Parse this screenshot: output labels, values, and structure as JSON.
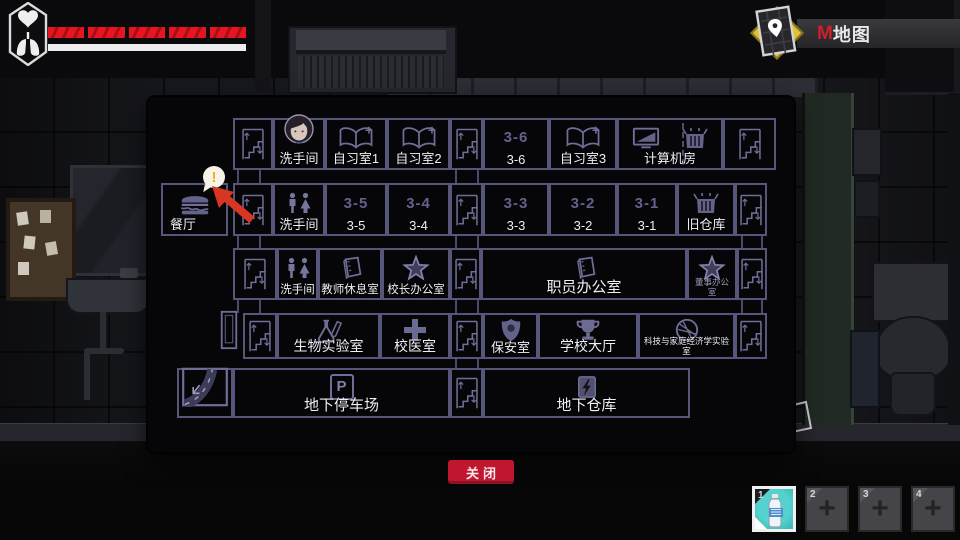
{
  "hud": {
    "health": {
      "segments": 5
    },
    "map_toggle": {
      "hotkey": "M",
      "label": "地图"
    },
    "inventory": {
      "slots": [
        {
          "number": "1",
          "item": "water-bottle",
          "selected": true
        },
        {
          "number": "2",
          "item": null,
          "selected": false
        },
        {
          "number": "3",
          "item": null,
          "selected": false
        },
        {
          "number": "4",
          "item": null,
          "selected": false
        }
      ]
    }
  },
  "panel": {
    "close_label": "关闭",
    "alert": {
      "exclamation": "!"
    },
    "colors": {
      "room_outline": "#56567a",
      "label": "#eef0f5",
      "dim_number": "#62628c",
      "close_button": "#c0172f",
      "alert_yellow": "#e8b41c",
      "arrow_red": "#d93622"
    },
    "rows": [
      {
        "y": 21,
        "h": 52,
        "cells": [
          {
            "type": "stairs",
            "icon": "stairs",
            "x": 85,
            "w": 40
          },
          {
            "type": "room",
            "label": "洗手间",
            "icon": "avatar",
            "x": 125,
            "w": 52
          },
          {
            "type": "room",
            "label": "自习室1",
            "icon": "book",
            "x": 177,
            "w": 62
          },
          {
            "type": "room",
            "label": "自习室2",
            "icon": "book",
            "x": 239,
            "w": 63
          },
          {
            "type": "stairs",
            "icon": "stairs",
            "x": 302,
            "w": 33
          },
          {
            "type": "room",
            "label": "3-6",
            "icon_text": "3-6",
            "x": 335,
            "w": 66
          },
          {
            "type": "room",
            "label": "自习室3",
            "icon": "book",
            "x": 401,
            "w": 68
          },
          {
            "type": "room",
            "label": "计算机房",
            "icon": "computerbox",
            "x": 469,
            "w": 106,
            "dashed": true
          },
          {
            "type": "stairs",
            "icon": "stairs",
            "x": 575,
            "w": 53
          }
        ]
      },
      {
        "y": 86,
        "h": 53,
        "cells": [
          {
            "type": "room",
            "label": "餐厅",
            "icon": "burger",
            "x": 13,
            "w": 67,
            "align": "left"
          },
          {
            "type": "stairs",
            "icon": "stairs",
            "x": 85,
            "w": 40
          },
          {
            "type": "room",
            "label": "洗手间",
            "icon": "wc",
            "x": 125,
            "w": 52
          },
          {
            "type": "room",
            "label": "3-5",
            "icon_text": "3-5",
            "x": 177,
            "w": 62
          },
          {
            "type": "room",
            "label": "3-4",
            "icon_text": "3-4",
            "x": 239,
            "w": 63
          },
          {
            "type": "stairs",
            "icon": "stairs",
            "x": 302,
            "w": 33
          },
          {
            "type": "room",
            "label": "3-3",
            "icon_text": "3-3",
            "x": 335,
            "w": 66
          },
          {
            "type": "room",
            "label": "3-2",
            "icon_text": "3-2",
            "x": 401,
            "w": 68
          },
          {
            "type": "room",
            "label": "3-1",
            "icon_text": "3-1",
            "x": 469,
            "w": 60
          },
          {
            "type": "room",
            "label": "旧仓库",
            "icon": "box",
            "x": 529,
            "w": 58
          },
          {
            "type": "stairs",
            "icon": "stairs",
            "x": 587,
            "w": 32
          }
        ]
      },
      {
        "y": 151,
        "h": 52,
        "cells": [
          {
            "type": "stairs",
            "icon": "stairs",
            "x": 85,
            "w": 44
          },
          {
            "type": "room",
            "label": "洗手间",
            "icon": "wc",
            "x": 129,
            "w": 41,
            "label_size": 11.5
          },
          {
            "type": "room",
            "label": "教师休息室",
            "icon": "notebook",
            "x": 170,
            "w": 64,
            "label_size": 11.5
          },
          {
            "type": "room",
            "label": "校长办公室",
            "icon": "star",
            "x": 234,
            "w": 68,
            "label_size": 11.5
          },
          {
            "type": "stairs",
            "icon": "stairs",
            "x": 302,
            "w": 31
          },
          {
            "type": "room",
            "label": "职员办公室",
            "icon": "notebook",
            "x": 333,
            "w": 206,
            "label_size": 15
          },
          {
            "type": "room",
            "label": "董事办公室",
            "icon": "star",
            "x": 539,
            "w": 50,
            "small": true,
            "dim": true
          },
          {
            "type": "stairs",
            "icon": "stairs",
            "x": 589,
            "w": 30
          }
        ]
      },
      {
        "y": 216,
        "h": 46,
        "cells": [
          {
            "type": "door",
            "icon": "door",
            "x": 68,
            "w": 25
          },
          {
            "type": "stairs",
            "icon": "stairs",
            "x": 95,
            "w": 34
          },
          {
            "type": "room",
            "label": "生物实验室",
            "icon": "flask",
            "x": 129,
            "w": 103,
            "label_size": 14
          },
          {
            "type": "room",
            "label": "校医室",
            "icon": "cross",
            "x": 232,
            "w": 70,
            "label_size": 14
          },
          {
            "type": "stairs",
            "icon": "stairs",
            "x": 302,
            "w": 33
          },
          {
            "type": "room",
            "label": "保安室",
            "icon": "badge",
            "x": 335,
            "w": 55
          },
          {
            "type": "room",
            "label": "学校大厅",
            "icon": "trophy",
            "x": 390,
            "w": 100,
            "label_size": 14
          },
          {
            "type": "room",
            "label": "科技与家庭经济学实验室",
            "icon": "globe",
            "x": 490,
            "w": 97,
            "small": true
          },
          {
            "type": "stairs",
            "icon": "stairs",
            "x": 587,
            "w": 32
          }
        ]
      },
      {
        "y": 271,
        "h": 50,
        "cells": [
          {
            "type": "room",
            "icon": "road",
            "x": 29,
            "w": 56
          },
          {
            "type": "room",
            "label": "地下停车场",
            "icon": "parking",
            "icon_text": "P",
            "x": 85,
            "w": 217,
            "label_size": 15
          },
          {
            "type": "stairs",
            "icon": "stairs",
            "x": 302,
            "w": 33
          },
          {
            "type": "room",
            "label": "地下仓库",
            "icon": "lightning",
            "x": 335,
            "w": 207,
            "label_size": 15
          }
        ]
      }
    ]
  }
}
